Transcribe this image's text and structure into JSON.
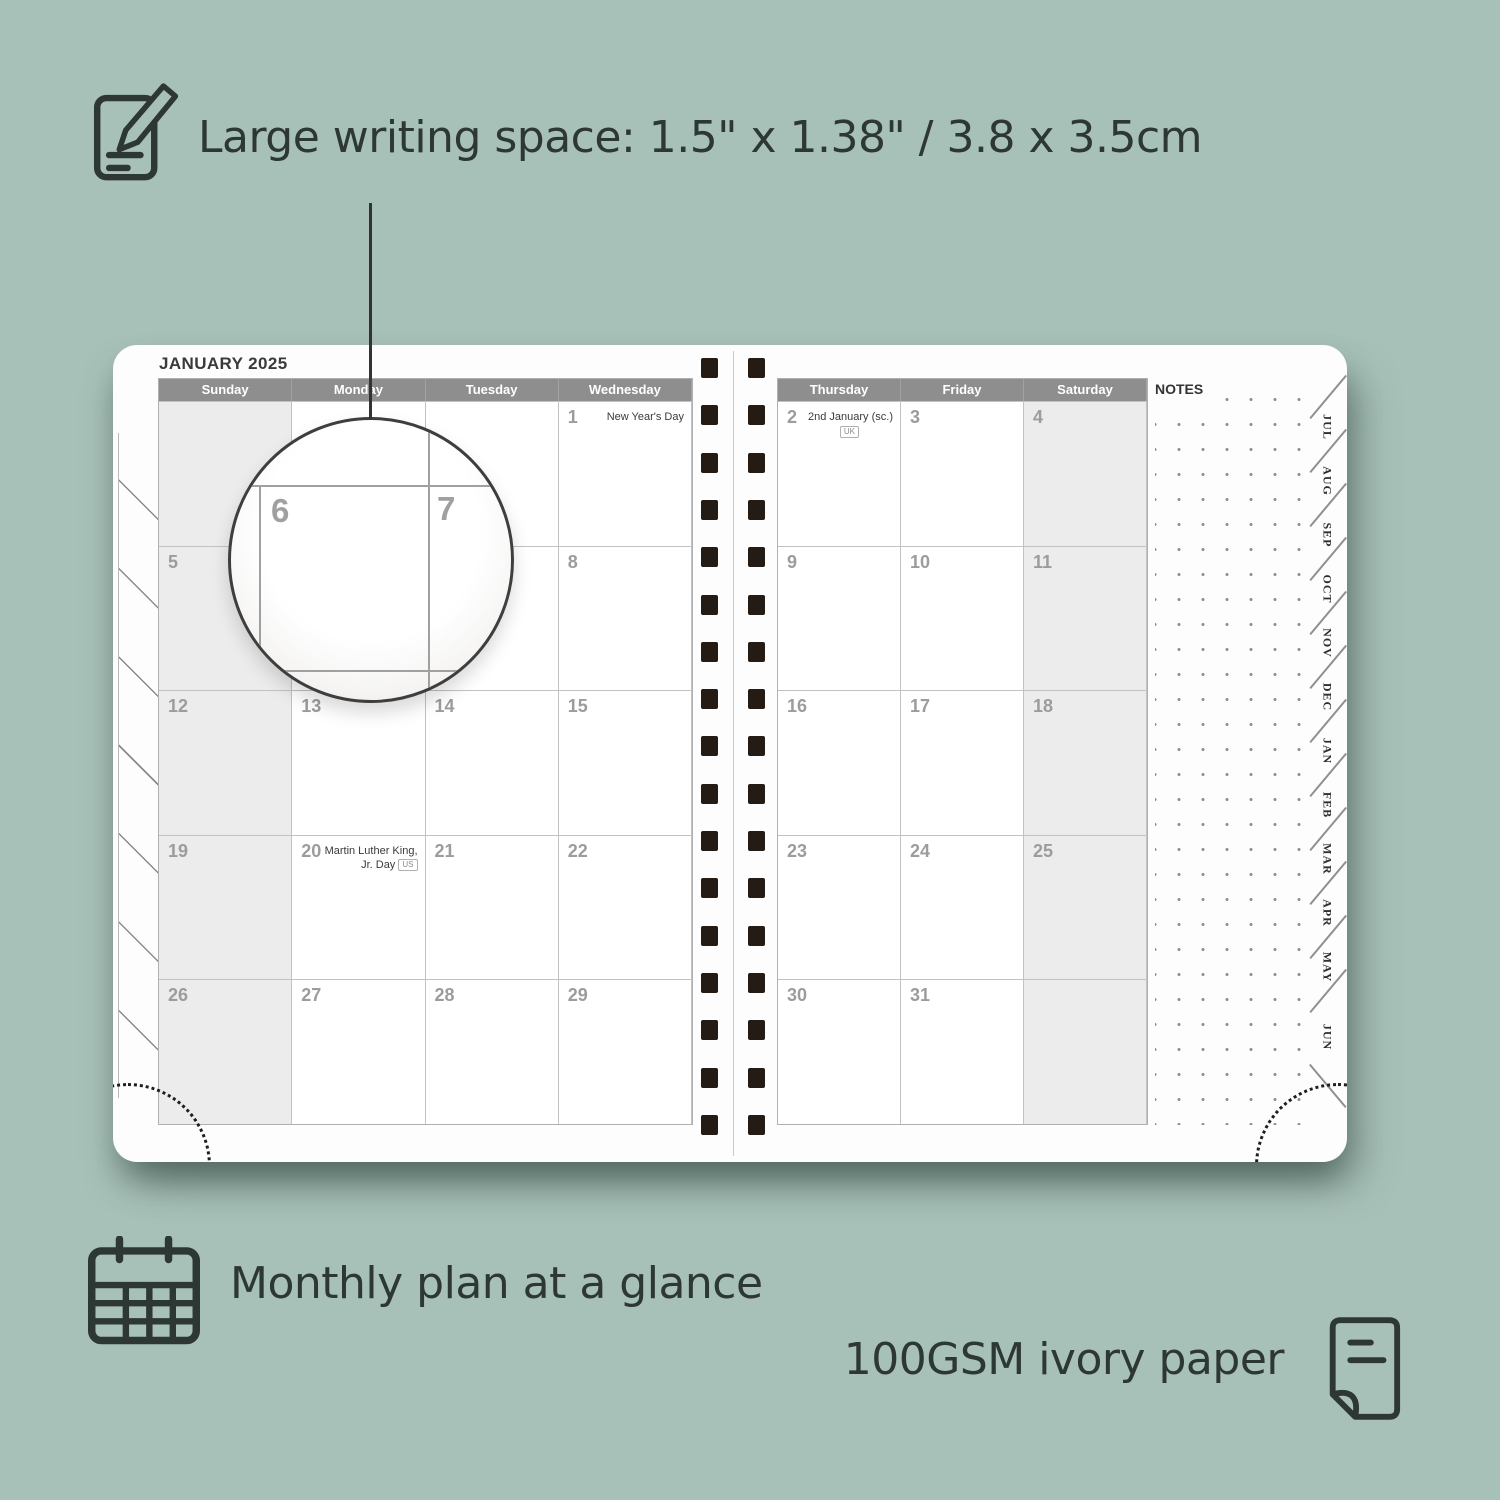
{
  "colors": {
    "background": "#a8c1b8",
    "ink": "#2d3733",
    "page": "#fdfdfd",
    "header_bar": "#8e8e8e",
    "weekend_fill": "#ececec",
    "date_number": "#9c9c9c",
    "grid_line": "#c2c2c2",
    "binding_hole": "#251b15"
  },
  "features": {
    "writing_space": {
      "icon": "notepad-pencil-icon",
      "label": "Large writing space: 1.5\" x 1.38\" / 3.8 x 3.5cm"
    },
    "monthly_plan": {
      "icon": "calendar-grid-icon",
      "label": "Monthly plan at a glance"
    },
    "paper": {
      "icon": "paper-sheet-icon",
      "label": "100GSM ivory paper"
    }
  },
  "planner": {
    "month_title": "JANUARY 2025",
    "notes_label": "NOTES",
    "left_page": {
      "day_headers": [
        "Sunday",
        "Monday",
        "Tuesday",
        "Wednesday"
      ],
      "weekend_columns": [
        0
      ],
      "weeks": [
        [
          "",
          "",
          "",
          {
            "day": "1",
            "holiday": "New Year's Day"
          }
        ],
        [
          "5",
          "6",
          "7",
          "8"
        ],
        [
          "12",
          "13",
          "14",
          "15"
        ],
        [
          "19",
          {
            "day": "20",
            "holiday": "Martin Luther King, Jr. Day",
            "region_tag": "US"
          },
          "21",
          "22"
        ],
        [
          "26",
          "27",
          "28",
          "29"
        ]
      ]
    },
    "right_page": {
      "day_headers": [
        "Thursday",
        "Friday",
        "Saturday"
      ],
      "weekend_columns": [
        2
      ],
      "weeks": [
        [
          {
            "day": "2",
            "holiday": "2nd January (sc.)",
            "region_tag": "UK",
            "tag_below": true
          },
          "3",
          "4"
        ],
        [
          "9",
          "10",
          "11"
        ],
        [
          "16",
          "17",
          "18"
        ],
        [
          "23",
          "24",
          "25"
        ],
        [
          "30",
          "31",
          ""
        ]
      ]
    },
    "month_tabs": [
      "JUL",
      "AUG",
      "SEP",
      "OCT",
      "NOV",
      "DEC",
      "JAN",
      "FEB",
      "MAR",
      "APR",
      "MAY",
      "JUN"
    ],
    "magnifier": {
      "left_date": "6",
      "right_date": "7"
    },
    "binding_holes_per_column": 17
  }
}
